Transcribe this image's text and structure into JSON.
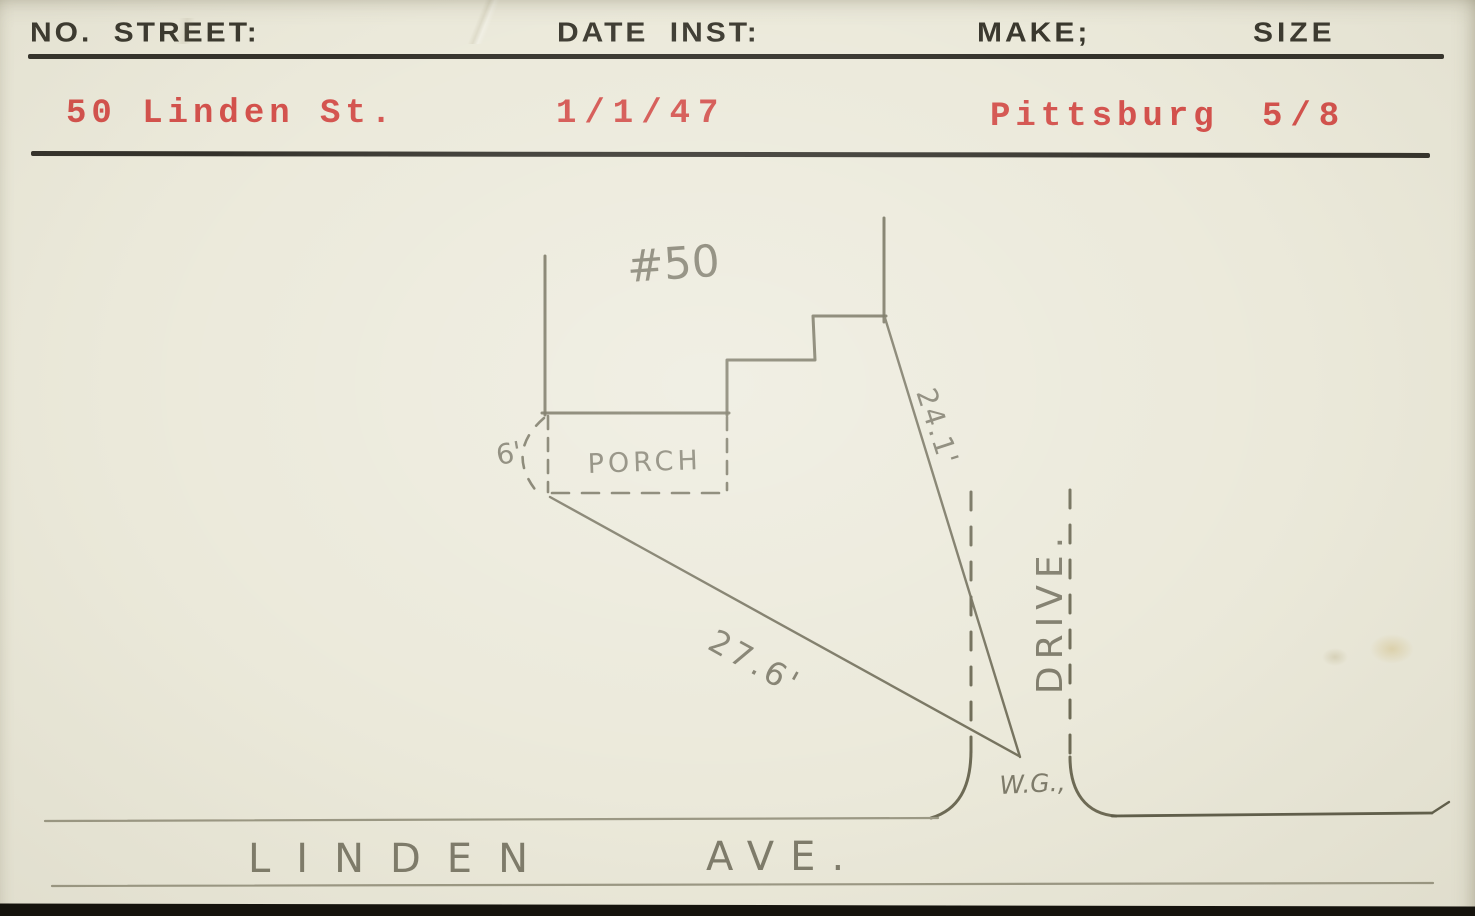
{
  "card": {
    "header": {
      "fields": [
        {
          "label": "NO. STREET:",
          "value": "50 Linden St."
        },
        {
          "label": "DATE INST:",
          "value": "1/1/47"
        },
        {
          "label": "MAKE;",
          "value": "Pittsburg"
        },
        {
          "label": "SIZE",
          "value": "5/8"
        }
      ]
    },
    "sketch": {
      "house_number": "#50",
      "porch_label": "PORCH",
      "offset_dim": "6'",
      "dim_to_house": "24.1'",
      "dim_to_porch": "27.6'",
      "curb_box_label": "W.G.,",
      "drive_label": "DRIVE.",
      "street_name": "LINDEN",
      "street_suffix": "AVE."
    },
    "colors": {
      "ink_red": "#d3514c",
      "print_black": "#3a382e",
      "pencil_gray": "#6b6857",
      "paper": "#ebe9da"
    }
  }
}
